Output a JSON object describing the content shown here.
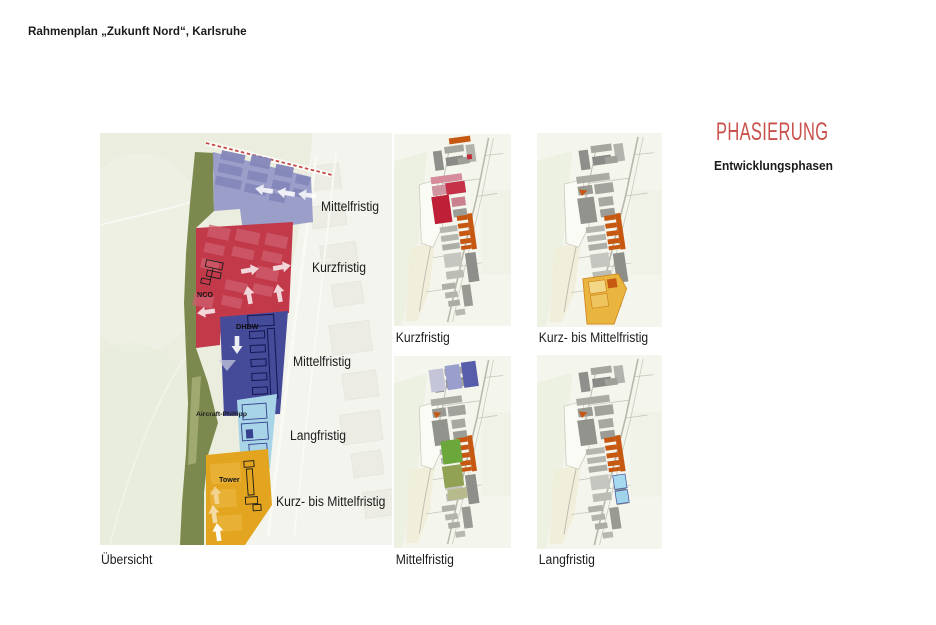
{
  "page": {
    "title": "Rahmenplan „Zukunft Nord“, Karlsruhe"
  },
  "header": {
    "title": "PHASIERUNG",
    "subtitle": "Entwicklungsphasen",
    "accent": "#c9504b"
  },
  "palette": {
    "map_background": "#ebeedf",
    "greenbelt_olive": "#7c894e",
    "kurzfristig_red": "#c2394a",
    "mittelfristig_lavender": "#9b9ec8",
    "mittelfristig_blue": "#454a99",
    "langfristig_lightblue": "#a7d5e7",
    "kurz_mittel_amber": "#e3a51f",
    "highlight_orange": "#c75812"
  },
  "overview": {
    "caption": "Übersicht",
    "zone_labels": [
      {
        "text": "Mittelfristig"
      },
      {
        "text": "Kurzfristig"
      },
      {
        "text": "Mittelfristig"
      },
      {
        "text": "Langfristig"
      },
      {
        "text": "Kurz- bis Mittelfristig"
      }
    ],
    "annotations": {
      "nco": "NCO",
      "dhbw": "DHBW",
      "aircraft": "Aircraft-Phillipp",
      "tower": "Tower"
    }
  },
  "phase_maps": [
    {
      "label": "Kurzfristig"
    },
    {
      "label": "Kurz- bis Mittelfristig"
    },
    {
      "label": "Mittelfristig"
    },
    {
      "label": "Langfristig"
    }
  ]
}
